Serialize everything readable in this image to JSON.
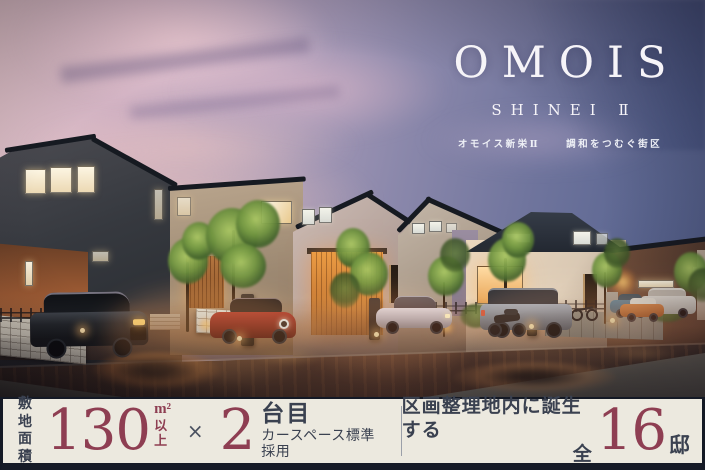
{
  "logo": {
    "brand": "OMOIS",
    "series": "SHINEI Ⅱ",
    "name_jp": "オモイス新栄Ⅱ",
    "tagline_jp": "調和をつむぐ街区"
  },
  "banner": {
    "site_area": {
      "label_line1": "敷地",
      "label_line2": "面積",
      "value": "130",
      "unit": "m²",
      "unit_suffix": "以上"
    },
    "multiply_sign": "×",
    "car_space": {
      "value": "2",
      "unit": "台目",
      "description": "カースペース標準採用"
    },
    "total_homes": {
      "description": "区画整理地内に誕生する",
      "prefix": "全",
      "value": "16",
      "unit": "邸"
    }
  },
  "colors": {
    "accent_maroon": "#8e3e52",
    "banner_background": "#ece9df",
    "banner_frame_navy": "#161b27",
    "text_dark_navy": "#3a4150",
    "logo_white": "#f6f4f8"
  }
}
